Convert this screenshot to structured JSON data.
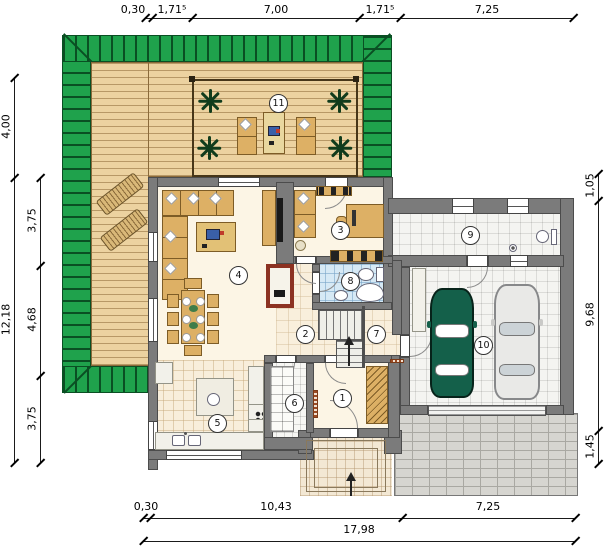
{
  "dims": {
    "top": [
      "0,30",
      "1,71⁵",
      "7,00",
      "1,71⁵",
      "7,25"
    ],
    "left_outer": [
      "4,00",
      "12,18"
    ],
    "left_inner": [
      "3,75",
      "4,68",
      "3,75"
    ],
    "right": [
      "1,05",
      "9,68",
      "1,45"
    ],
    "bottom": [
      "0,30",
      "10,43",
      "7,25"
    ],
    "total_width": "17,98"
  },
  "rooms": [
    "1",
    "2",
    "3",
    "4",
    "5",
    "6",
    "7",
    "8",
    "9",
    "10",
    "11"
  ],
  "colors": {
    "grass_green": "#1fa24c",
    "deck_wood": "#ecd2a0",
    "wall_gray": "#7b7b7b",
    "furniture_tan": "#ddb065",
    "fireplace_red": "#8c3222",
    "car_green": "#14604a",
    "car_silver": "#e9e9e7",
    "bath_tile_blue": "#d6e9f5"
  }
}
